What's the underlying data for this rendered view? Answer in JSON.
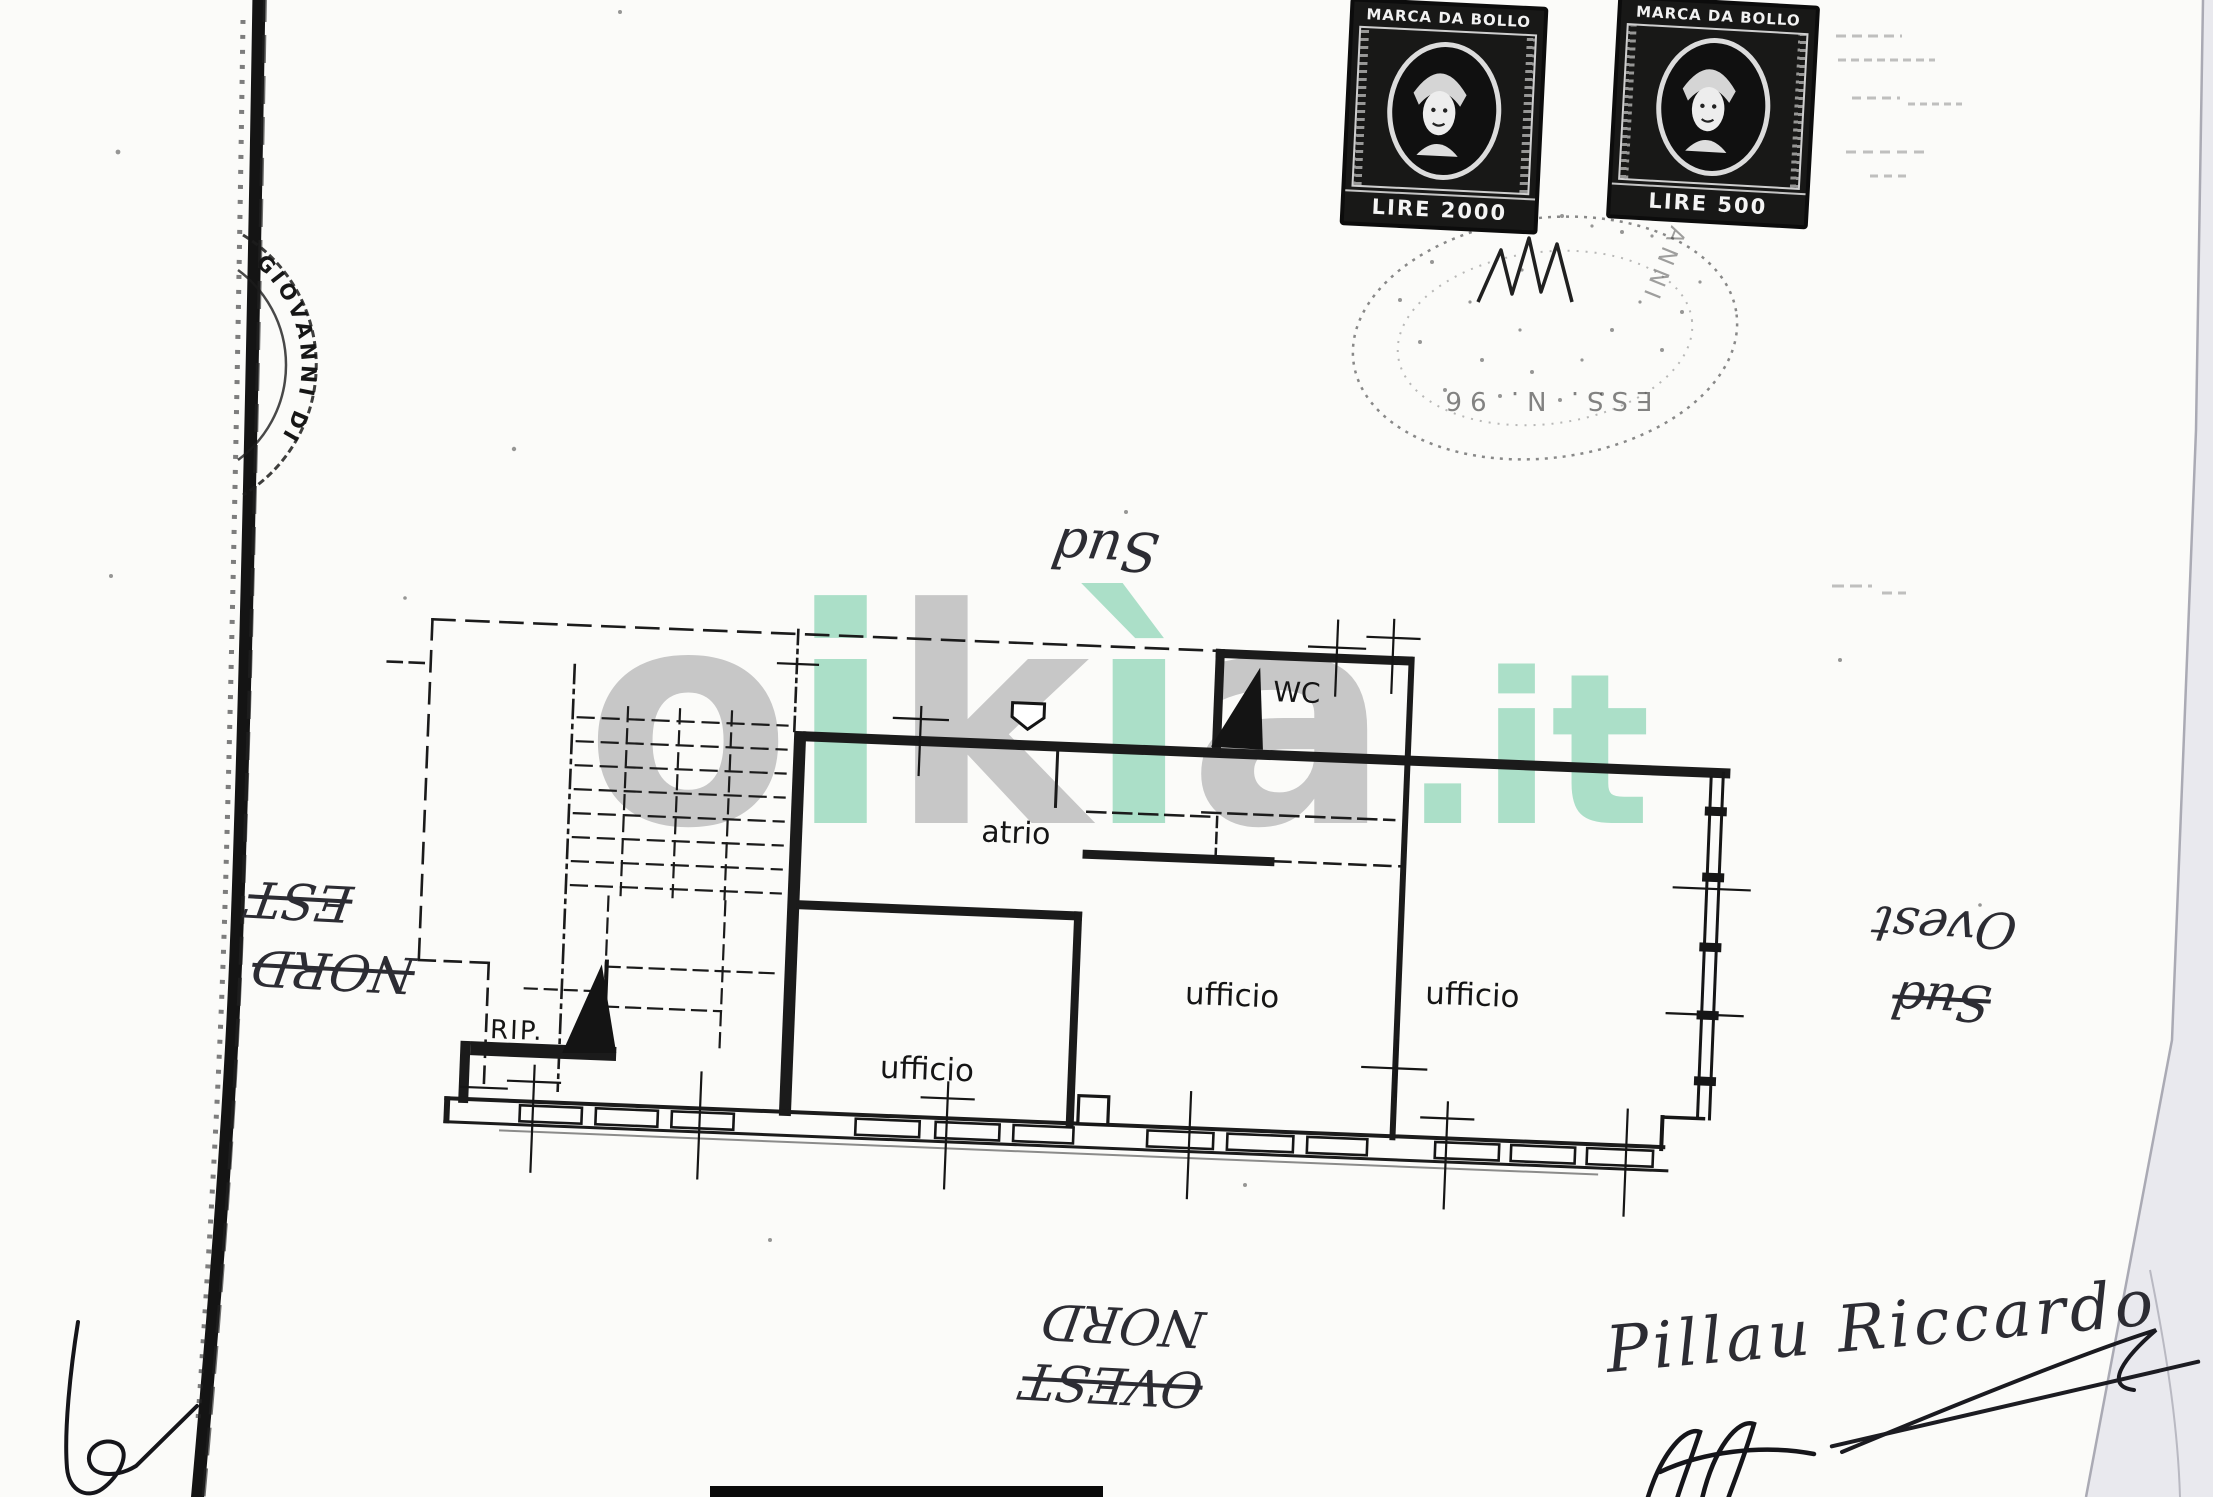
{
  "page": {
    "background": "#fbfbf9"
  },
  "stamps": {
    "left": {
      "header": "MARCA DA BOLLO",
      "denomination": "LIRE 2000"
    },
    "right": {
      "header": "MARCA DA BOLLO",
      "denomination": "LIRE 500"
    }
  },
  "postmark": {
    "arc_text": "ESS. N. 96",
    "side_text": "ANNI"
  },
  "edge_stamp": {
    "arc_text": "GIOVANNI DI"
  },
  "watermark": {
    "letters": [
      {
        "ch": "o",
        "tone": "gray"
      },
      {
        "ch": "i",
        "tone": "teal"
      },
      {
        "ch": "k",
        "tone": "gray"
      },
      {
        "ch": "ì",
        "tone": "teal"
      },
      {
        "ch": "a",
        "tone": "gray"
      }
    ],
    "suffix": ".it",
    "gray": "#c7c7c7",
    "teal": "#abdfc8"
  },
  "plan": {
    "rooms": {
      "atrio": "atrio",
      "wc": "WC",
      "rip": "RIP.",
      "ufficio_left": "ufficio",
      "ufficio_middle": "ufficio",
      "ufficio_right": "ufficio"
    }
  },
  "orientation_notes": {
    "top": {
      "label": "Sud",
      "struck": false
    },
    "left_upper": {
      "label": "EST",
      "struck": true
    },
    "left_lower": {
      "label": "NORD",
      "struck": true
    },
    "right_upper": {
      "label": "Ovest",
      "struck": false
    },
    "right_lower": {
      "label": "Sud",
      "struck": true
    },
    "bottom_upper": {
      "label": "NORD",
      "struck": false
    },
    "bottom_lower": {
      "label": "OVEST",
      "struck": true
    }
  },
  "signature": {
    "name": "Pillau Riccardo",
    "partial": "Elle"
  }
}
